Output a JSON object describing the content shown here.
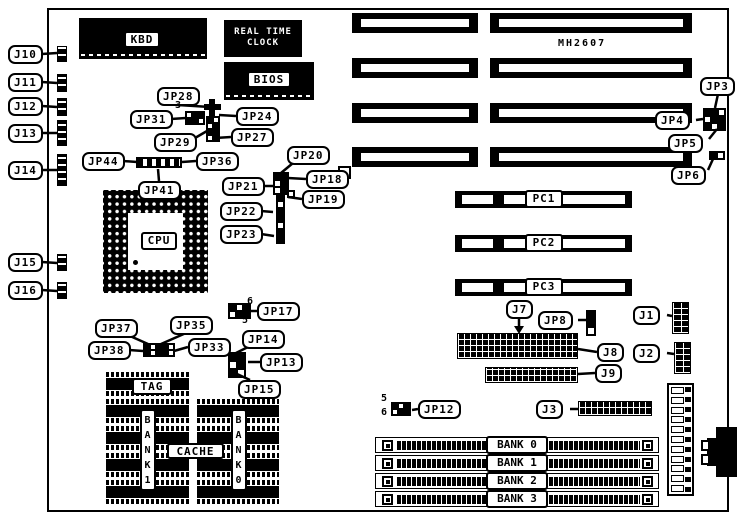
{
  "board_model": "MH2607",
  "chips": {
    "kbd": "KBD",
    "rtc_line1": "REAL TIME",
    "rtc_line2": "CLOCK",
    "bios": "BIOS",
    "cpu": "CPU",
    "tag": "TAG",
    "cache": "CACHE",
    "bank1": "BANK1",
    "bank0": "BANK0"
  },
  "slots": {
    "pci": [
      "PC1",
      "PC2",
      "PC3"
    ],
    "simm": [
      "BANK 0",
      "BANK 1",
      "BANK 2",
      "BANK 3"
    ]
  },
  "callouts": [
    {
      "id": "j10",
      "text": "J10"
    },
    {
      "id": "j11",
      "text": "J11"
    },
    {
      "id": "j12",
      "text": "J12"
    },
    {
      "id": "j13",
      "text": "J13"
    },
    {
      "id": "j14",
      "text": "J14"
    },
    {
      "id": "j15",
      "text": "J15"
    },
    {
      "id": "j16",
      "text": "J16"
    },
    {
      "id": "jp28",
      "text": "JP28"
    },
    {
      "id": "jp31",
      "text": "JP31"
    },
    {
      "id": "jp29",
      "text": "JP29"
    },
    {
      "id": "jp24",
      "text": "JP24"
    },
    {
      "id": "jp27",
      "text": "JP27"
    },
    {
      "id": "jp44",
      "text": "JP44"
    },
    {
      "id": "jp36",
      "text": "JP36"
    },
    {
      "id": "jp41",
      "text": "JP41"
    },
    {
      "id": "jp20",
      "text": "JP20"
    },
    {
      "id": "jp21",
      "text": "JP21"
    },
    {
      "id": "jp18",
      "text": "JP18"
    },
    {
      "id": "jp19",
      "text": "JP19"
    },
    {
      "id": "jp22",
      "text": "JP22"
    },
    {
      "id": "jp23",
      "text": "JP23"
    },
    {
      "id": "jp3",
      "text": "JP3"
    },
    {
      "id": "jp4",
      "text": "JP4"
    },
    {
      "id": "jp5",
      "text": "JP5"
    },
    {
      "id": "jp6",
      "text": "JP6"
    },
    {
      "id": "jp17",
      "text": "JP17"
    },
    {
      "id": "jp37",
      "text": "JP37"
    },
    {
      "id": "jp35",
      "text": "JP35"
    },
    {
      "id": "jp38",
      "text": "JP38"
    },
    {
      "id": "jp33",
      "text": "JP33"
    },
    {
      "id": "jp14",
      "text": "JP14"
    },
    {
      "id": "jp13",
      "text": "JP13"
    },
    {
      "id": "jp15",
      "text": "JP15"
    },
    {
      "id": "jp12",
      "text": "JP12"
    },
    {
      "id": "jp8",
      "text": "JP8"
    },
    {
      "id": "j7",
      "text": "J7"
    },
    {
      "id": "j8",
      "text": "J8"
    },
    {
      "id": "j9",
      "text": "J9"
    },
    {
      "id": "j1",
      "text": "J1"
    },
    {
      "id": "j2",
      "text": "J2"
    },
    {
      "id": "j3",
      "text": "J3"
    }
  ],
  "pin_numbers": [
    {
      "id": "jp31_3",
      "text": "3"
    },
    {
      "id": "jp17_6",
      "text": "6"
    },
    {
      "id": "jp17_5",
      "text": "5"
    },
    {
      "id": "jp12_5",
      "text": "5"
    },
    {
      "id": "jp12_6",
      "text": "6"
    }
  ],
  "colors": {
    "ink": "#000000",
    "paper": "#ffffff"
  }
}
